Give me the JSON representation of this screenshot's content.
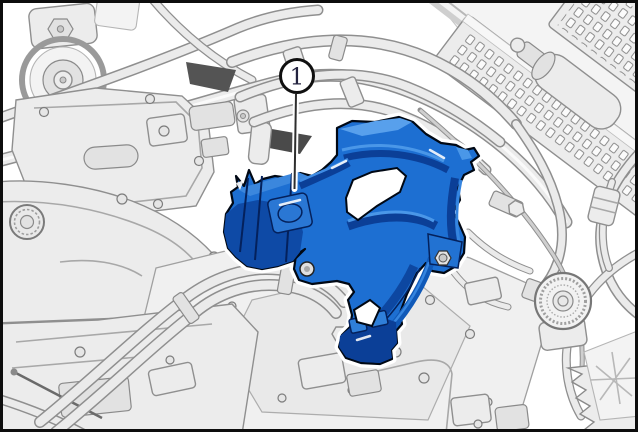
{
  "colors": {
    "background": "#ffffff",
    "frame_border": "#0d0d0d",
    "line_art_stroke": "#8f8f8f",
    "line_art_fill": "#ececec",
    "highlight_main": "#1d6fd2",
    "highlight_dark": "#0c3f97",
    "highlight_light": "#58a0ec",
    "callout_text": "#23233f"
  },
  "callout": {
    "label": "1"
  }
}
